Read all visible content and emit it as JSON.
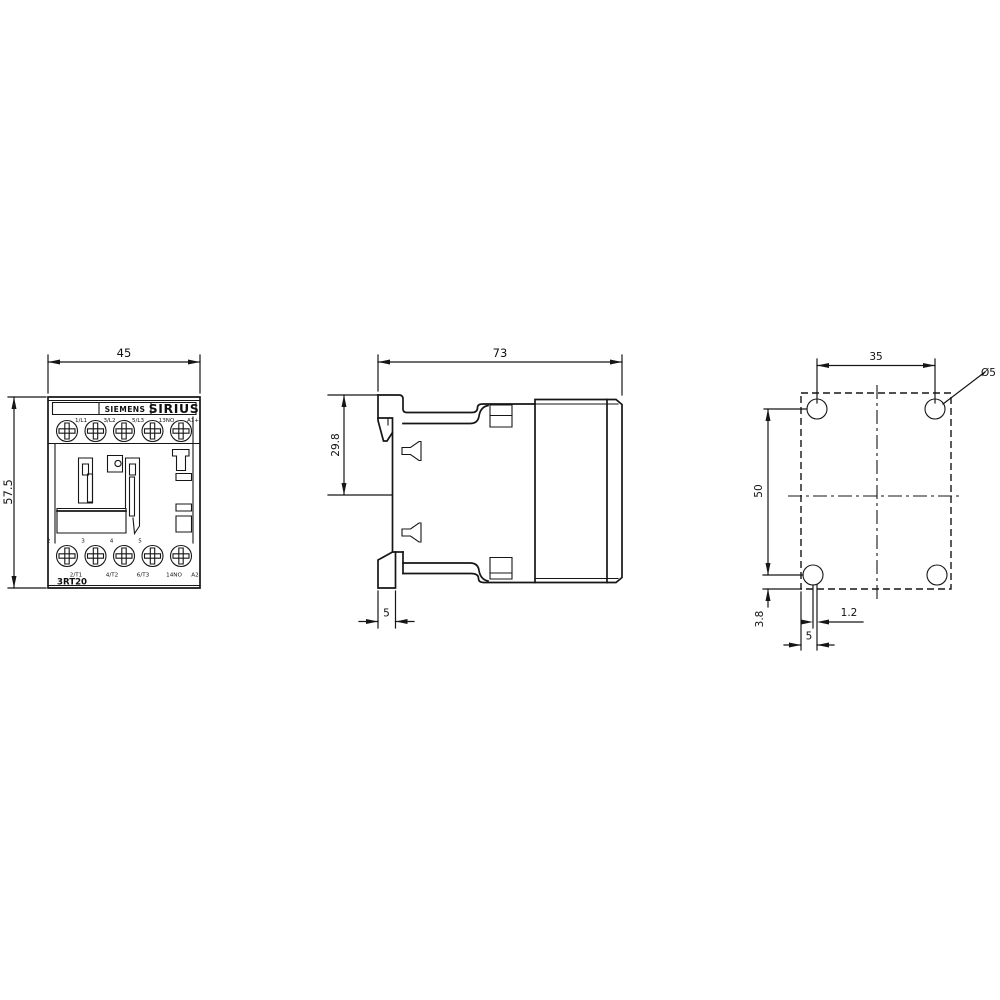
{
  "front_view": {
    "brand": "SIEMENS",
    "series": "SIRIUS",
    "model": "3RT20",
    "width_dim": "45",
    "height_dim": "57.5",
    "top_terminals": [
      "1/L1",
      "3/L2",
      "5/L3",
      "13NO",
      "A1+"
    ],
    "pole_numbers": [
      "2",
      "3",
      "4",
      "5"
    ],
    "bottom_terminals": [
      "2/T1",
      "4/T2",
      "6/T3",
      "14NO",
      "A2-"
    ]
  },
  "side_view": {
    "depth_dim": "73",
    "clip_offset_dim": "29.8",
    "flange_depth_dim": "5"
  },
  "drill_pattern": {
    "hole_spacing_horizontal": "35",
    "hole_spacing_vertical": "50",
    "bottom_edge_offset": "3.8",
    "hole_line_offset": "1.2",
    "side_edge_offset": "5",
    "hole_diameter": "Ø5"
  }
}
